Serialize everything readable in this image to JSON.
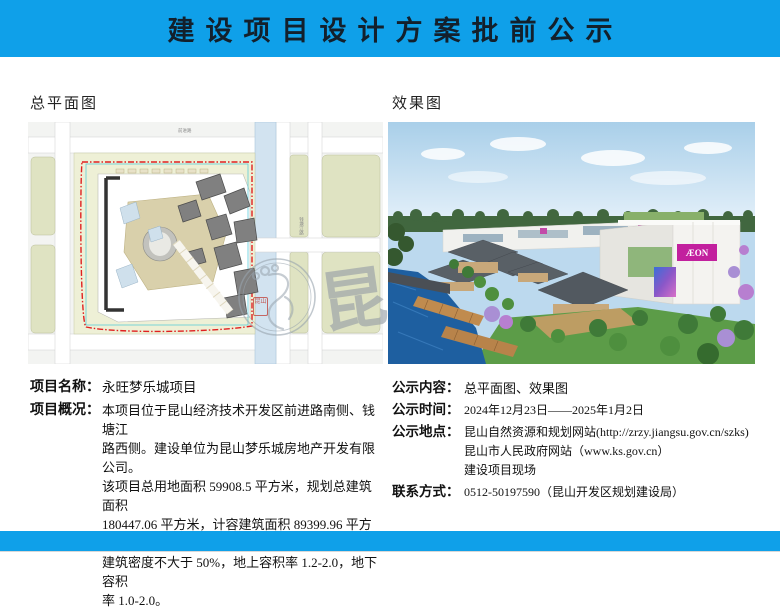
{
  "header": {
    "title": "建设项目设计方案批前公示"
  },
  "captions": {
    "left": "总平面图",
    "right": "效果图"
  },
  "site_plan": {
    "road_top_label": "前进路",
    "road_right_label": "钱塘江路"
  },
  "rendering": {
    "sign": "ÆON"
  },
  "watermark": {
    "glyph": "昆",
    "seal": "昆山"
  },
  "project": {
    "name_label": "项目名称：",
    "name_value": "永旺梦乐城项目",
    "overview_label": "项目概况：",
    "overview_lines": [
      "本项目位于昆山经济技术开发区前进路南侧、钱塘江",
      "路西侧。建设单位为昆山梦乐城房地产开发有限公司。",
      "该项目总用地面积 59908.5 平方米，规划总建筑面积",
      "180447.06 平方米，计容建筑面积 89399.96 平方米；",
      "建筑密度不大于 50%，地上容积率 1.2-2.0，地下容积",
      "率 1.0-2.0。"
    ]
  },
  "notice": {
    "items": [
      {
        "label": "公示内容：",
        "lines": [
          "总平面图、效果图"
        ]
      },
      {
        "label": "公示时间：",
        "lines": [
          "2024年12月23日——2025年1月2日"
        ]
      },
      {
        "label": "公示地点：",
        "lines": [
          "昆山自然资源和规划网站(http://zrzy.jiangsu.gov.cn/szks)",
          "昆山市人民政府网站（www.ks.gov.cn）",
          "建设项目现场"
        ]
      },
      {
        "label": "联系方式：",
        "lines": [
          "0512-50197590（昆山开发区规划建设局）"
        ]
      }
    ]
  },
  "colors": {
    "accent_blue": "#0fa0e9",
    "title_text": "#13202c",
    "boundary_red": "#e02020",
    "aeon_magenta": "#c2209e",
    "canal_blue": "#d2e3f0",
    "parcel_olive": "#dfe3c2"
  }
}
